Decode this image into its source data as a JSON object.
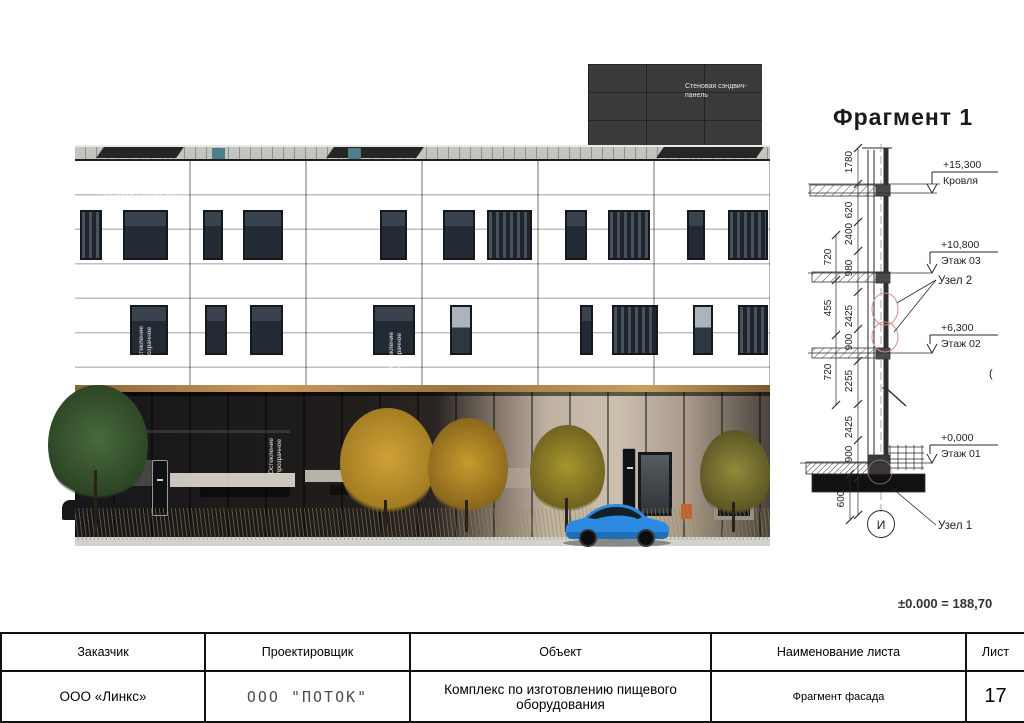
{
  "colors": {
    "facade": "#2f302b",
    "led_strip": "#c0925a",
    "car_accent": "#2e8fe0",
    "detail_marker": "#d98c8c"
  },
  "render": {
    "tower_panel_label": "Стеновая сэндвич-панель",
    "panel_label_top": "Стеновая сэндвич-панель",
    "panel_label_mid_left": "Стеновая сэндвич-панель",
    "panel_label_mid_center": "Стеновая сэндвич-панель",
    "glazing_label_f2_left": "Остекление прозрачное",
    "glazing_label_f2_center": "Остекление прозрачное",
    "glazing_label_ground": "Остекление прозрачное"
  },
  "fragment": {
    "title": "Фрагмент 1",
    "levels": [
      {
        "elevation": "+15,300",
        "label": "Кровля"
      },
      {
        "elevation": "+10,800",
        "label": "Этаж 03"
      },
      {
        "elevation": "+6,300",
        "label": "Этаж 02"
      },
      {
        "elevation": "+0,000",
        "label": "Этаж 01"
      }
    ],
    "nodes": {
      "node2": "Узел 2",
      "node1": "Узел 1"
    },
    "axis_label": "И",
    "dims_inner": [
      "1780",
      "620",
      "2400",
      "980",
      "2425",
      "900",
      "2255",
      "2425",
      "900"
    ],
    "dims_outer": [
      "720",
      "455",
      "720"
    ],
    "dim_base": "600",
    "stray_mark": "(",
    "datum_note": "±0.000 = 188,70"
  },
  "title_block": {
    "headers": [
      "Заказчик",
      "Проектировщик",
      "Объект",
      "Наименование листа",
      "Лист"
    ],
    "customer": "ООО «Линкс»",
    "designer": "ООО \"ПОТОК\"",
    "object": "Комплекс по изготовлению пищевого оборудования",
    "sheet_name": "Фрагмент фасада",
    "sheet_number": "17"
  }
}
